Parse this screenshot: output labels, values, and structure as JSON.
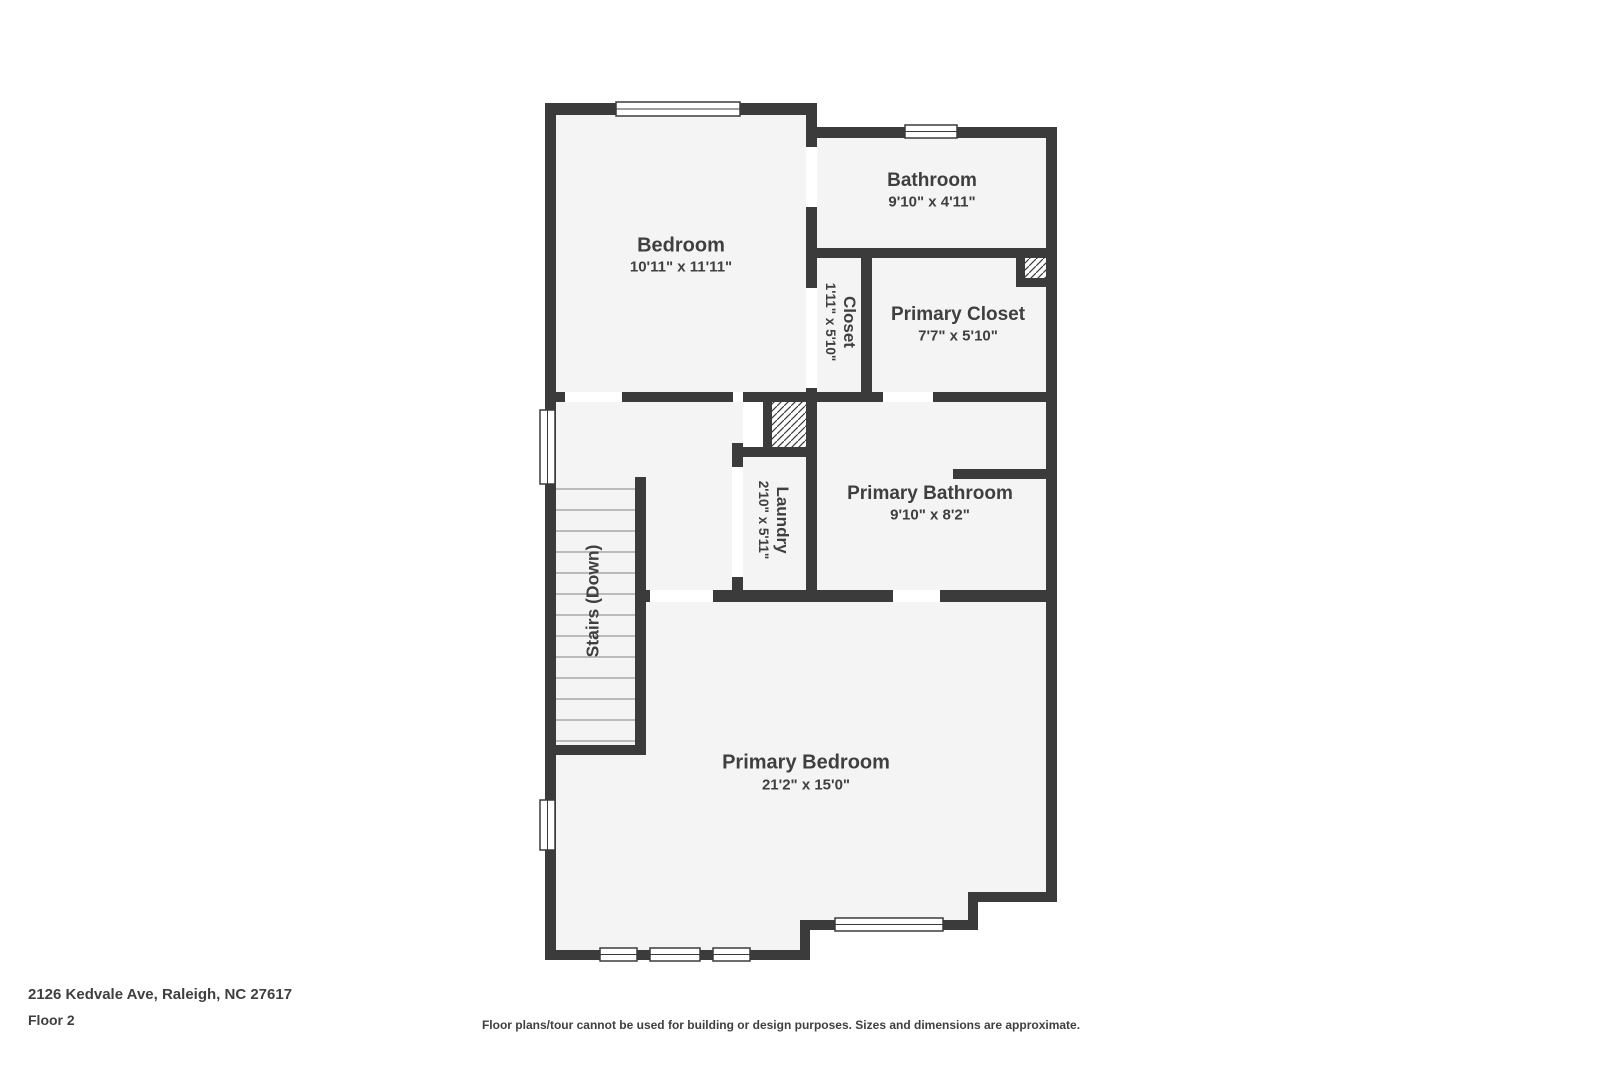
{
  "palette": {
    "wall": "#3b3b3b",
    "floor": "#f4f4f4",
    "door_gap": "#ffffff",
    "text": "#3f3f3f",
    "tread": "#a8a8a8",
    "bg": "#ffffff"
  },
  "rooms": {
    "bedroom": {
      "name": "Bedroom",
      "dims": "10'11\" x 11'11\""
    },
    "bathroom": {
      "name": "Bathroom",
      "dims": "9'10\" x 4'11\""
    },
    "closet": {
      "name": "Closet",
      "dims": "1'11\" x 5'10\""
    },
    "primary_closet": {
      "name": "Primary Closet",
      "dims": "7'7\" x 5'10\""
    },
    "laundry": {
      "name": "Laundry",
      "dims": "2'10\" x 5'11\""
    },
    "primary_bathroom": {
      "name": "Primary Bathroom",
      "dims": "9'10\" x 8'2\""
    },
    "stairs": {
      "name": "Stairs (Down)"
    },
    "primary_bedroom": {
      "name": "Primary Bedroom",
      "dims": "21'2\" x 15'0\""
    }
  },
  "footer": {
    "address": "2126 Kedvale Ave, Raleigh, NC 27617",
    "floor_label": "Floor 2",
    "disclaimer": "Floor plans/tour cannot be used for building or design purposes. Sizes and dimensions are approximate."
  }
}
